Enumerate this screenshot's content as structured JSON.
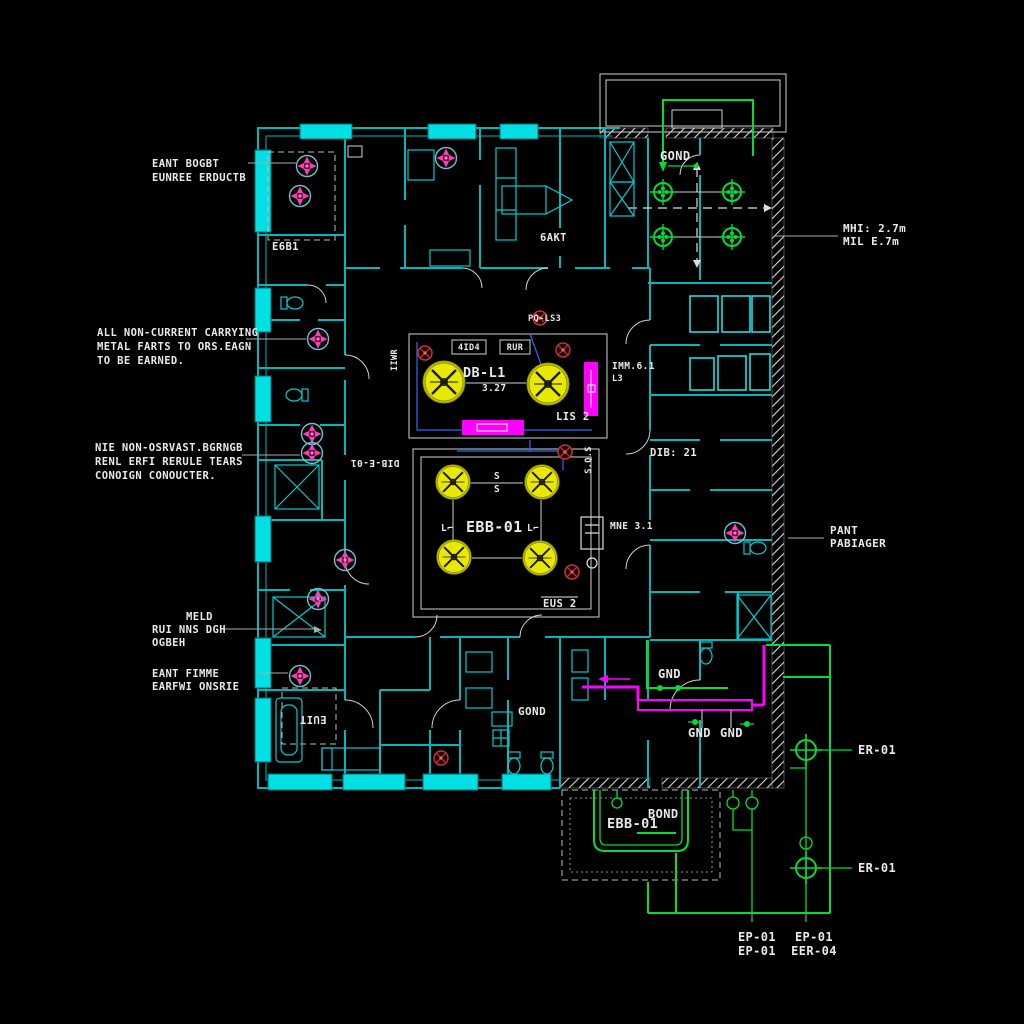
{
  "drawing": {
    "colors": {
      "background": "#000000",
      "wall_cyan": "#00b7bb",
      "window_cyan": "#00dfe3",
      "wiring_green": "#00dd33",
      "bus_magenta": "#ff00ff",
      "luminaire_yellow": "#e8e800",
      "fan_pink": "#ff3db8",
      "detector_red": "#c23434",
      "text_white": "#e9e9e9"
    }
  },
  "callouts": {
    "note1_l1": "EANT BOGBT",
    "note1_l2": "EUNREE ERDUCTB",
    "note2_l1": "ALL NON-CURRENT CARRYING",
    "note2_l2": "METAL FARTS TO ORS.EAGN",
    "note2_l3": "TO BE EARNED.",
    "note3_l1": "NIE NON-OSRVAST.BGRNGB",
    "note3_l2": "RENL ERFI RERULE TEARS",
    "note3_l3": "CONOIGN CONOUCTER.",
    "note4_l1": "MELD",
    "note4_l2": "RUI NNS DGH",
    "note4_l3": "OGBEH",
    "note5_l1": "EANT FIMME",
    "note5_l2": "EARFWI ONSRIE",
    "note6_l1": "MHI: 2.7m",
    "note6_l2": "MIL E.7m",
    "note7_l1": "PANT",
    "note7_l2": "PABIAGER",
    "er01_top": "ER-01",
    "er01_bottom": "ER-01",
    "ep_a1": "EP-01",
    "ep_a2": "EP-01",
    "ep_b1": "EP-01",
    "ep_b2": "EER-04"
  },
  "plan": {
    "gond_top": "GOND",
    "e6b1": "E6B1",
    "bakt": "6AKT",
    "pq_ls3": "PQ-LS3",
    "db_name": "DB-L1",
    "db_num": "3.27",
    "box_a": "4ID4",
    "box_b": "RUR",
    "imm": "IMM.6.1",
    "l3": "L3",
    "lis2": "LIS 2",
    "iiwr": "IIWR",
    "dib_e01": "DIB-E-01",
    "ebb": "EBB-01",
    "s_top": "S",
    "s_mid": "S",
    "l_left": "L⌐",
    "l_right": "L⌐",
    "sqs": "S.Q.S",
    "mne": "MNE 3.1",
    "eus2": "EUS 2",
    "dib21": "DIB: 21",
    "gnd1": "GND",
    "gnd2": "GND",
    "gnd3": "GND",
    "gond_bottom": "GOND",
    "euit": "EUIT",
    "ebb_bottom": "EBB-01",
    "bond": "BOND"
  }
}
